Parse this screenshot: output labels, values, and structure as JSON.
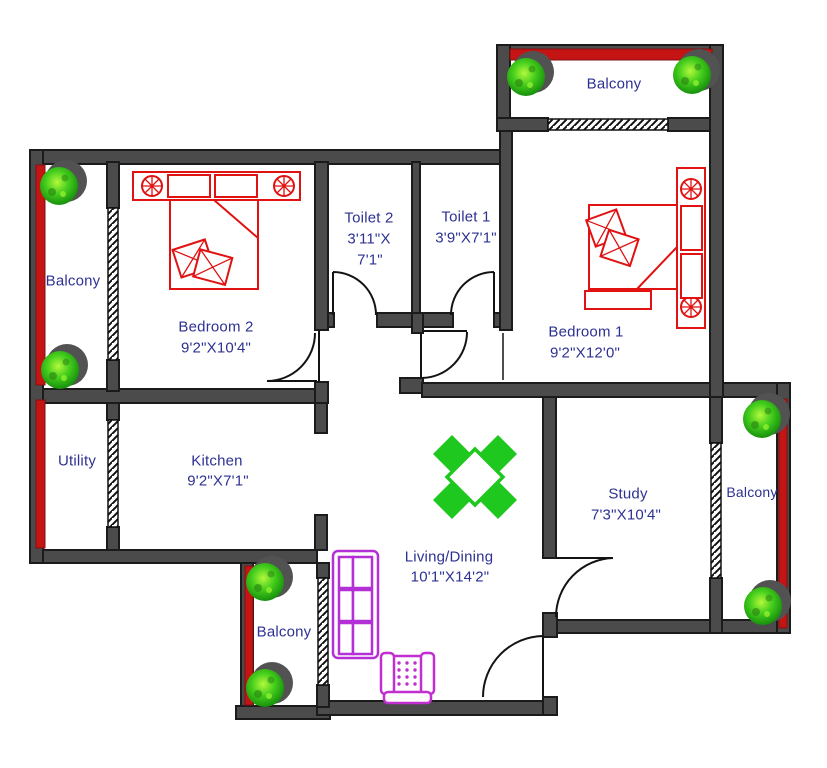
{
  "rooms": {
    "balcony_top": {
      "name": "Balcony"
    },
    "balcony_left": {
      "name": "Balcony"
    },
    "balcony_right": {
      "name": "Balcony"
    },
    "balcony_bottom": {
      "name": "Balcony"
    },
    "bedroom2": {
      "name": "Bedroom 2",
      "dims": "9'2\"X10'4\""
    },
    "toilet2": {
      "name": "Toilet 2",
      "dims1": "3'11\"X",
      "dims2": "7'1\""
    },
    "toilet1": {
      "name": "Toilet 1",
      "dims": "3'9\"X7'1\""
    },
    "bedroom1": {
      "name": "Bedroom 1",
      "dims": "9'2\"X12'0\""
    },
    "utility": {
      "name": "Utility"
    },
    "kitchen": {
      "name": "Kitchen",
      "dims": "9'2\"X7'1\""
    },
    "living_dining": {
      "name": "Living/Dining",
      "dims": "10'1\"X14'2\""
    },
    "study": {
      "name": "Study",
      "dims": "7'3\"X10'4\""
    }
  },
  "furniture": {
    "bedroom2_bed": "double-bed-with-side-tables",
    "bedroom1_bed": "double-bed-with-side-tables",
    "bedroom1_wardrobe": "wardrobe",
    "dining_table": "four-seater-dining-table",
    "sofa": "three-seat-sofa",
    "armchair": "armchair",
    "plants": "potted-plants-x8"
  },
  "colors": {
    "wall": "#4b4b4b",
    "wall_outline": "#1b1b1b",
    "terrace_red": "#c41414",
    "furniture_red": "#e01212",
    "table_green": "#1ec81e",
    "sofa_purple": "#b32fd6",
    "armchair_purple": "#c12fd1",
    "label_navy": "#2d3193",
    "background": "#ffffff"
  }
}
